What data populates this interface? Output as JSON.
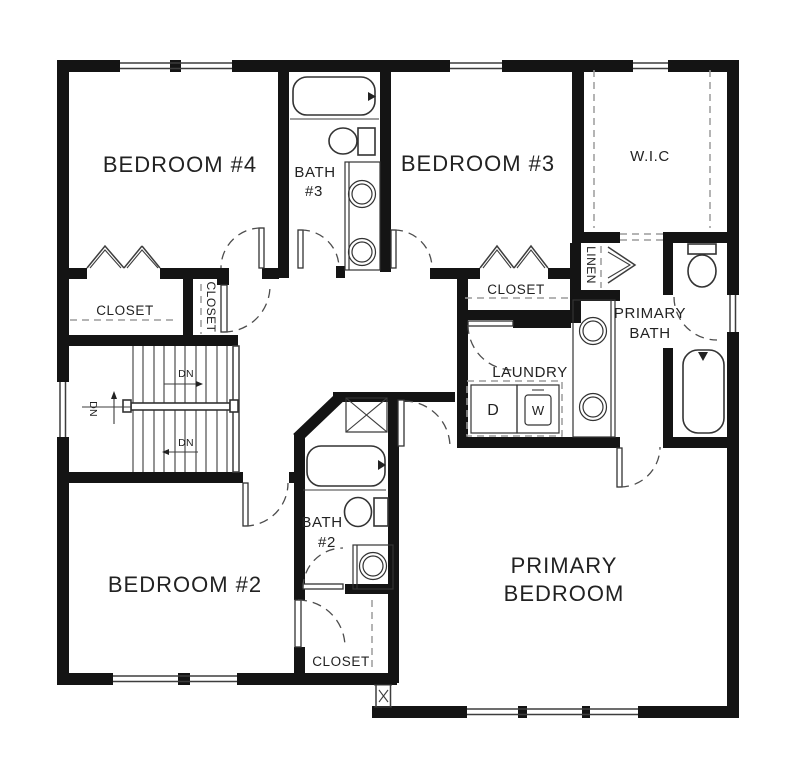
{
  "colors": {
    "wall_color": "#141414",
    "line_color": "#3d3d3d",
    "dash_color": "#9c9c9c",
    "text_color": "#222222",
    "background": "#ffffff"
  },
  "plan": {
    "rooms": {
      "bedroom4": {
        "label": "BEDROOM #4"
      },
      "bath3": {
        "line1": "BATH",
        "line2": "#3"
      },
      "bedroom3": {
        "label": "BEDROOM #3"
      },
      "wic": {
        "label": "W.I.C"
      },
      "closet_bedroom4": {
        "label": "CLOSET"
      },
      "closet_hall": {
        "label": "CLOSET"
      },
      "closet_bedroom3": {
        "label": "CLOSET"
      },
      "linen": {
        "label": "LINEN"
      },
      "primary_bath": {
        "line1": "PRIMARY",
        "line2": "BATH"
      },
      "laundry": {
        "label": "LAUNDRY",
        "dryer": "D",
        "washer": "W"
      },
      "bedroom2": {
        "label": "BEDROOM #2"
      },
      "bath2": {
        "line1": "BATH",
        "line2": "#2"
      },
      "closet_bedroom2": {
        "label": "CLOSET"
      },
      "primary_bedroom": {
        "line1": "PRIMARY",
        "line2": "BEDROOM"
      }
    },
    "stairs": {
      "down_upper": "DN",
      "down_lower": "DN",
      "down_landing": "DN"
    }
  }
}
